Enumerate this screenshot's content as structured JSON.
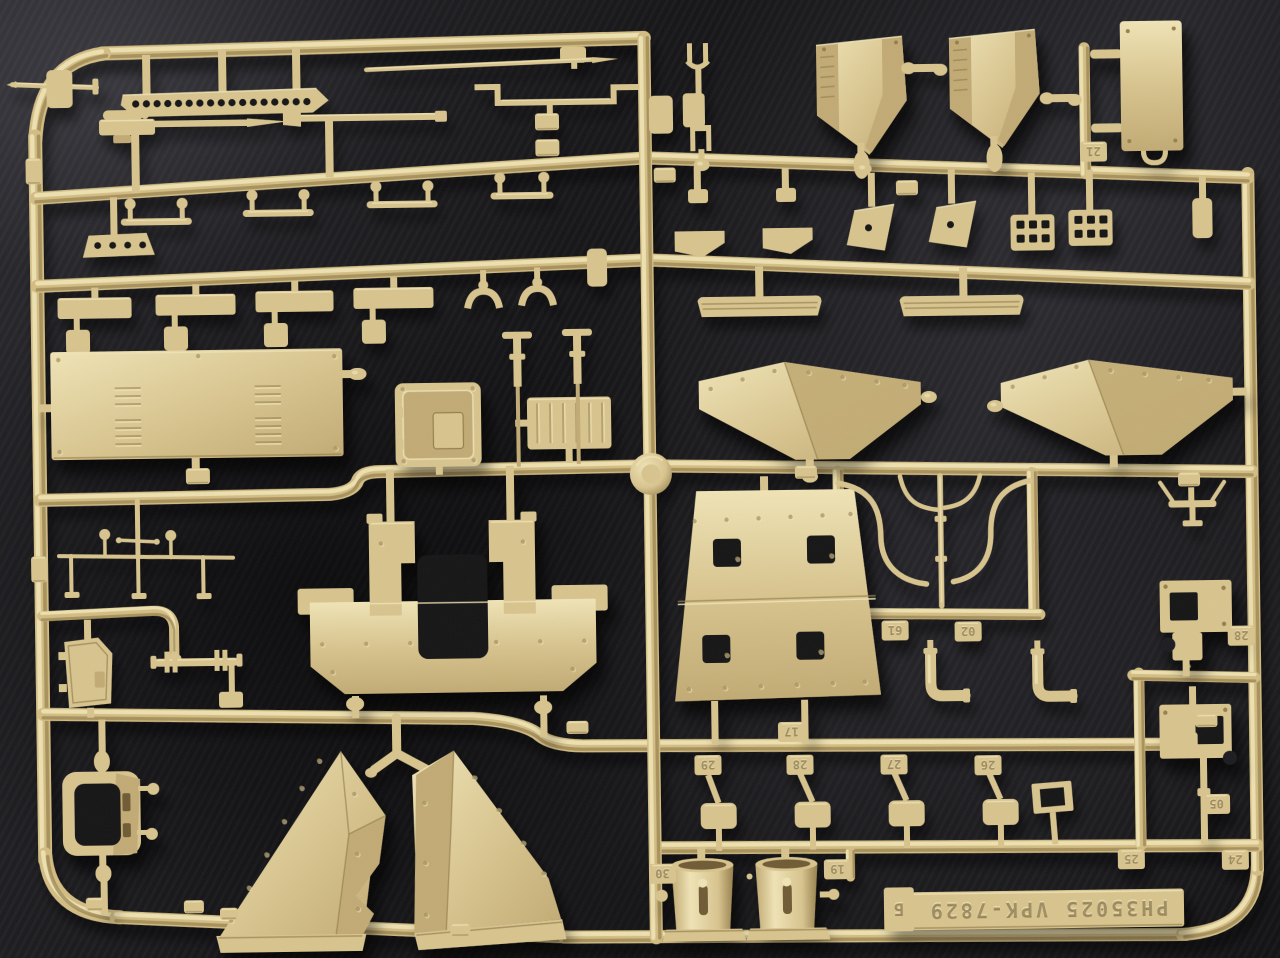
{
  "scene": {
    "type": "photograph",
    "subject": "Tan injection-molded plastic model kit sprue with armored-vehicle parts photographed on dark charcoal fabric",
    "plastic_color_name": "dark-yellow tan styrene",
    "background_name": "dark charcoal fabric"
  },
  "sprue_tag": {
    "text": "PH35025 VPK-7829",
    "letter": "Б",
    "kit_code": "PH35025",
    "mold_code": "VPK-7829",
    "orientation": "embossed lettering, upside-down in photo"
  },
  "part_tags": [
    "29",
    "28",
    "27",
    "26",
    "25",
    "24",
    "30",
    "19",
    "61",
    "02",
    "17",
    "21",
    "28",
    "05"
  ],
  "colors": {
    "plastic_light": "#f0e4b6",
    "plastic_base": "#d8c48e",
    "plastic_mid": "#c2ab74",
    "plastic_dark": "#96804d",
    "plastic_deep": "#6f5c34",
    "runner_base": "#d3bd84",
    "hole_dark": "#131315",
    "background": "#1e1e22",
    "background_light": "#3c3c42",
    "background_deep": "#0b0b0d"
  },
  "parts_identified": [
    "perforated mounting strip",
    "machine-gun barrel with sight",
    "gun barrel",
    "pointed rod",
    "Z-bracket strap",
    "hinge strip with holes",
    "grab handles",
    "stowage plates",
    "louvered engine deck panel",
    "square access hatch",
    "ribbed stowage box",
    "T-head pins",
    "wiper linkage",
    "side door hatch",
    "axle shaft with flanges",
    "window frame with ball studs",
    "hull rear plate with hatch opening",
    "large triangular gusset panels",
    "trapezoid plate with four openings",
    "fuel pipe cluster",
    "exhaust elbow pipes",
    "clevis fork",
    "faceted stowage bins",
    "fuel tank",
    "front fenders",
    "skid rails",
    "wedge brackets",
    "waffle tread plates",
    "angle plates",
    "antenna bracket",
    "hinge brackets with square holes",
    "small rectangular frame",
    "mounting pads",
    "air-cleaner cylinders",
    "embossed sprue code tag"
  ]
}
